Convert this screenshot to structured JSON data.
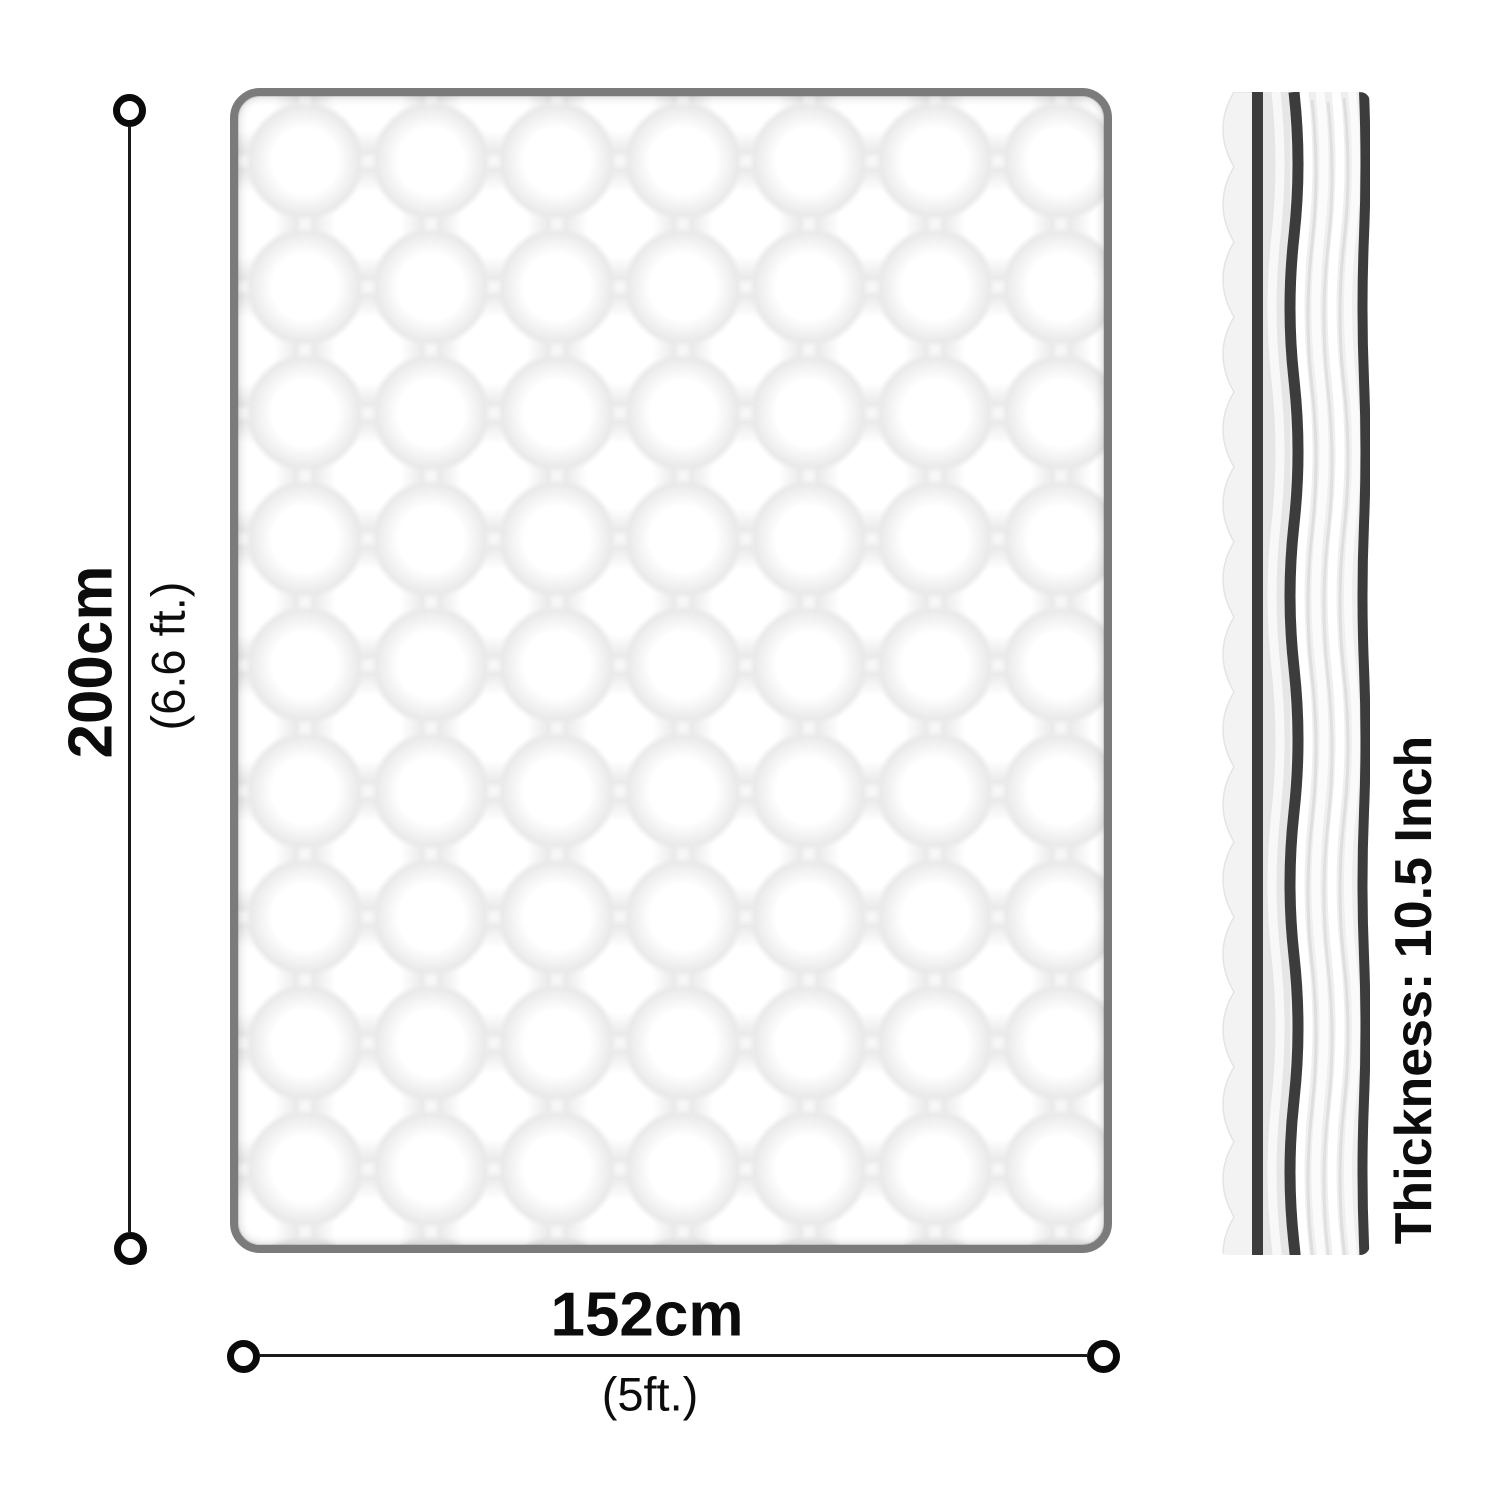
{
  "labels": {
    "height": {
      "value": "200cm",
      "alt": "(6.6 ft.)"
    },
    "width": {
      "value": "152cm",
      "alt": "(5ft.)"
    },
    "thickness": "Thickness: 10.5 Inch"
  },
  "colors": {
    "dimension_line": "#1a1a1a",
    "text": "#0c0c0c",
    "mattress_border": "#7b7b7b",
    "quilt_shadow": "#eaeaea",
    "piping_dark": "#3c3c3c",
    "side_fabric": "#efefef",
    "side_band": "#e6e6e6",
    "scallop_edge": "#f3f3f3"
  }
}
